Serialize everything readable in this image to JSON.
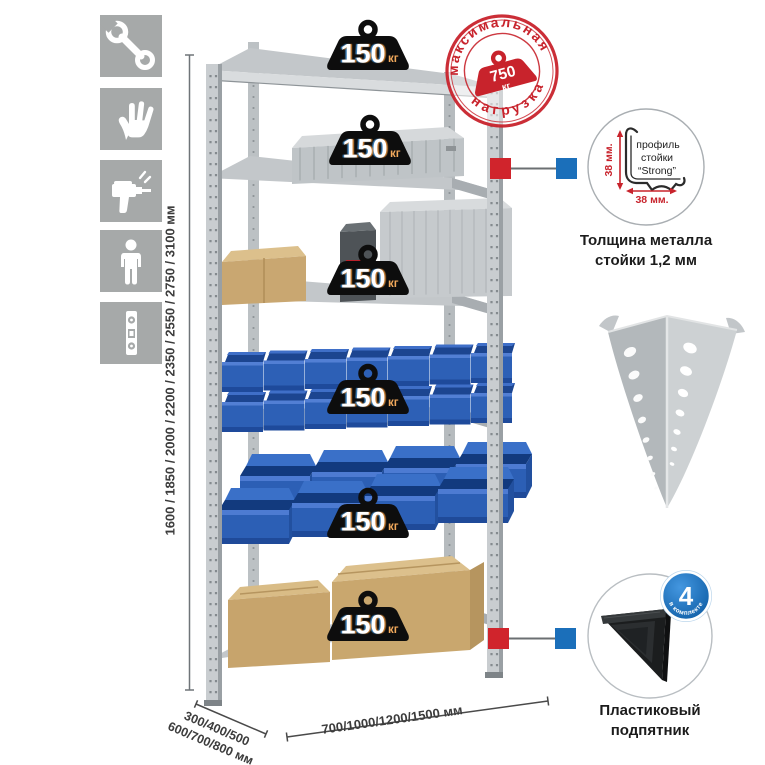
{
  "page": {
    "background": "#ffffff"
  },
  "left_icons": {
    "items": [
      {
        "name": "wrench"
      },
      {
        "name": "gloves"
      },
      {
        "name": "drill"
      },
      {
        "name": "person"
      },
      {
        "name": "level"
      }
    ]
  },
  "dimensions": {
    "height_label": "1600 / 1850 / 2000 / 2200 / 2350 / 2550 / 2750 / 3100 мм",
    "depth_label_line1": "300/400/500",
    "depth_label_line2": "600/700/800 мм",
    "width_label": "700/1000/1200/1500 мм"
  },
  "rack": {
    "shelf_count": 6,
    "shelf_load_value": "150",
    "shelf_load_unit": "кг"
  },
  "max_load_stamp": {
    "arc_top": "максимальная",
    "arc_bottom": "нагрузка",
    "weight_value": "750",
    "weight_unit": "кг"
  },
  "profile_callout": {
    "label_line1": "профиль",
    "label_line2": "стойки",
    "label_line3": "“Strong”",
    "dim_vertical": "38 мм.",
    "dim_horizontal": "38 мм.",
    "caption_line1": "Толщина металла",
    "caption_line2": "стойки 1,2 мм"
  },
  "foot_callout": {
    "badge_value": "4",
    "badge_text": "в комплекте",
    "caption_line1": "Пластиковый",
    "caption_line2": "подпятник"
  },
  "colors": {
    "accent_red": "#c8232c",
    "callout_blue": "#1b6fba",
    "bin_blue": "#2c5eb4",
    "metal_gray": "#c6cacc",
    "icon_gray": "#a6a9a9"
  }
}
